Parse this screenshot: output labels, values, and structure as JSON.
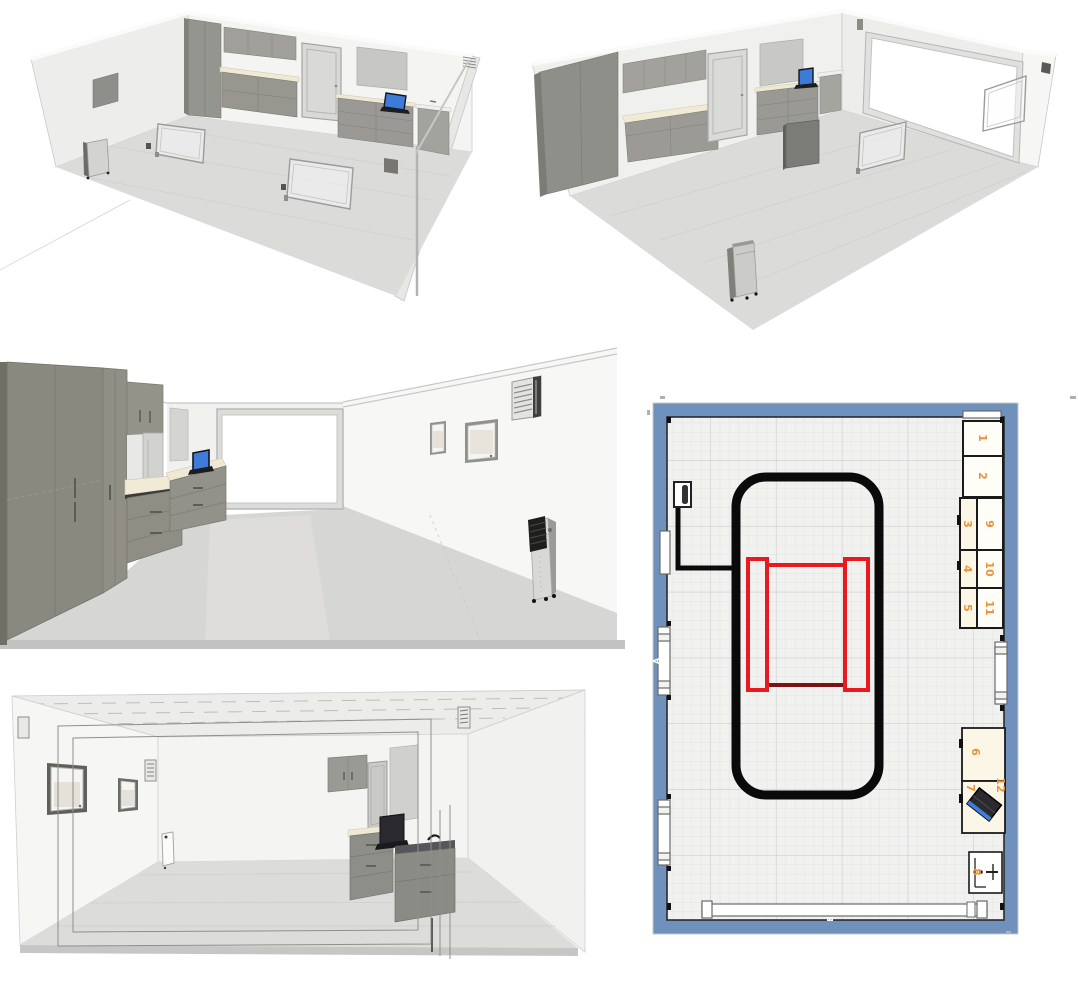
{
  "plan": {
    "labels": {
      "b1": "1",
      "b2": "2",
      "b3": "3",
      "b4": "4",
      "b5": "5",
      "b6": "6",
      "b7": "7",
      "b8": "8",
      "b9": "9",
      "b10": "10",
      "b11": "11",
      "b12": "12"
    },
    "markers": {
      "window_a": "A",
      "door_e": "E"
    },
    "colors": {
      "wall_blue": "#7191bd",
      "outline_black": "#0a0a0a",
      "outline_red": "#e8191f",
      "outline_dark_red": "#7a1216",
      "label_orange": "#e8943a",
      "box_cream": "#fcf6e6",
      "box_white": "#fffdf8",
      "laptop_blue": "#3f7cd9"
    }
  }
}
